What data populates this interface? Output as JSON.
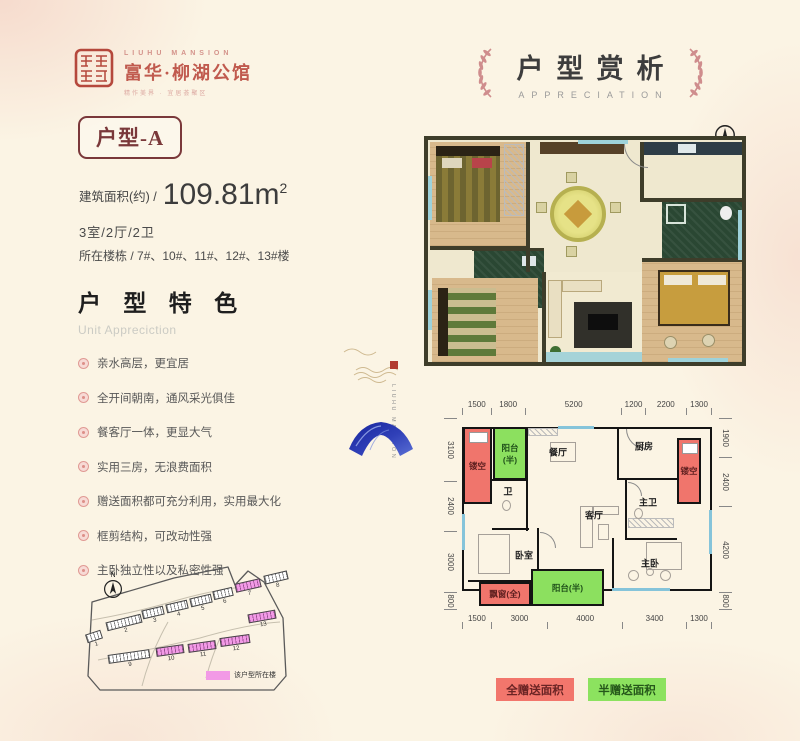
{
  "brand": {
    "en": "LIUHU MANSION",
    "cn": "富华·柳湖公馆",
    "tagline": "精作美界 · 宜居荟聚区"
  },
  "title": {
    "cn": "户型赏析",
    "en": "APPRECIATION"
  },
  "unit": {
    "badge": "户型-A",
    "area_label": "建筑面积(约) /",
    "area_value": "109.81m",
    "area_sup": "2",
    "layout": "3室/2厅/2卫",
    "floors_label": "所在楼栋 /",
    "floors": "7#、10#、11#、12#、13#楼"
  },
  "features": {
    "title": "户 型 特 色",
    "subtitle": "Unit Appreciction",
    "items": [
      "亲水高层，更宜居",
      "全开间朝南，通风采光俱佳",
      "餐客厅一体，更显大气",
      "实用三房，无浪费面积",
      "赠送面积都可充分利用，实用最大化",
      "框剪结构，可改动性强",
      "主卧独立性以及私密性强"
    ]
  },
  "siteplan": {
    "north": "N",
    "legend": "该户型所在楼",
    "buildings": [
      {
        "num": "1",
        "highlight": false
      },
      {
        "num": "2",
        "highlight": false
      },
      {
        "num": "3",
        "highlight": false
      },
      {
        "num": "4",
        "highlight": false
      },
      {
        "num": "5",
        "highlight": false
      },
      {
        "num": "6",
        "highlight": false
      },
      {
        "num": "7",
        "highlight": true
      },
      {
        "num": "8",
        "highlight": false
      },
      {
        "num": "9",
        "highlight": false
      },
      {
        "num": "10",
        "highlight": true
      },
      {
        "num": "11",
        "highlight": true
      },
      {
        "num": "12",
        "highlight": true
      },
      {
        "num": "13",
        "highlight": true
      }
    ]
  },
  "plan2d": {
    "dims": {
      "top": [
        "1500",
        "1800",
        "5200",
        "1200",
        "2200",
        "1300"
      ],
      "bottom": [
        "1500",
        "3000",
        "4000",
        "3400",
        "1300"
      ],
      "left": [
        "3100",
        "2400",
        "3000",
        "800"
      ],
      "right": [
        "1900",
        "2400",
        "4200",
        "800"
      ]
    },
    "rooms": [
      {
        "id": "hollow-left",
        "label": "镂空",
        "type": "red"
      },
      {
        "id": "balcony-top",
        "label": "阳台(半)",
        "type": "green"
      },
      {
        "id": "dining",
        "label": "餐厅",
        "type": "plain"
      },
      {
        "id": "kitchen",
        "label": "厨房",
        "type": "plain"
      },
      {
        "id": "hollow-right",
        "label": "镂空",
        "type": "red"
      },
      {
        "id": "master-bath",
        "label": "主卫",
        "type": "plain"
      },
      {
        "id": "bath",
        "label": "卫",
        "type": "plain"
      },
      {
        "id": "bedroom",
        "label": "卧室",
        "type": "plain"
      },
      {
        "id": "living",
        "label": "客厅",
        "type": "plain"
      },
      {
        "id": "master-bedroom",
        "label": "主卧",
        "type": "plain"
      },
      {
        "id": "bay-window",
        "label": "飘窗(全)",
        "type": "red"
      },
      {
        "id": "balcony-bottom",
        "label": "阳台(半)",
        "type": "green"
      }
    ]
  },
  "gift_legend": {
    "full": "全赠送面积",
    "half": "半赠送面积"
  },
  "colors": {
    "accent_red": "#f0756c",
    "accent_green": "#8ce05f",
    "highlight_pink": "#f29ae6",
    "maroon": "#7a383a",
    "brand_red": "#c05a4e",
    "laurel_pink": "#cf8d8d",
    "background": "#fbf4e4"
  }
}
